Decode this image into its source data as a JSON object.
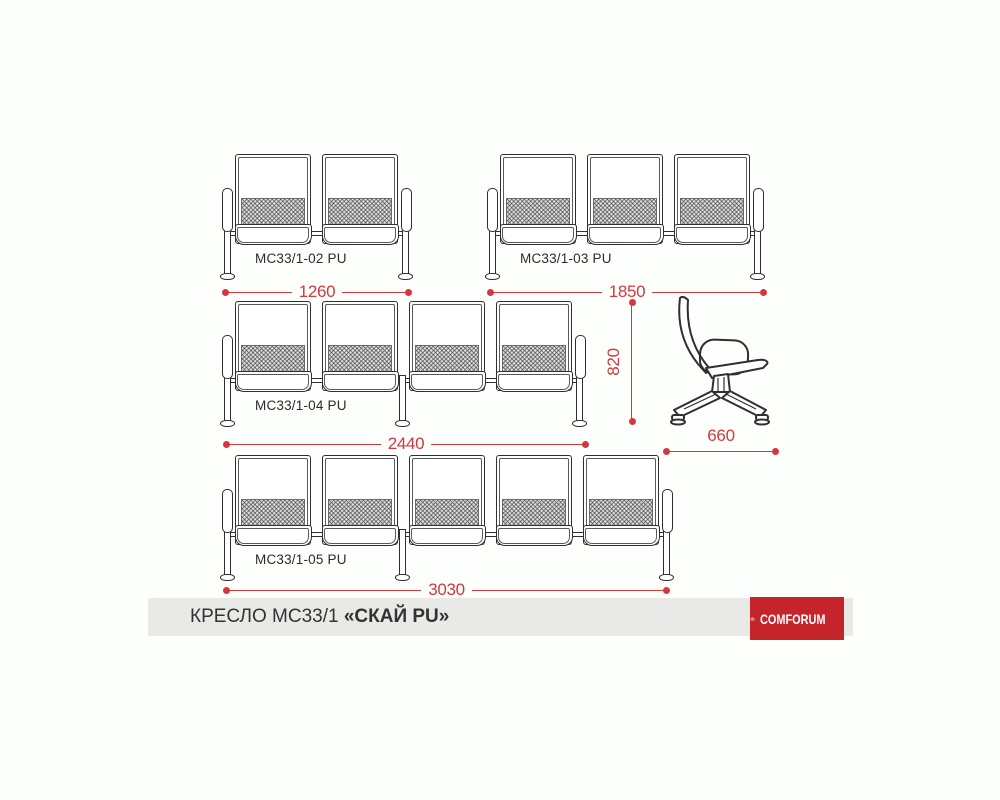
{
  "drawing": {
    "benches": [
      {
        "label": "MC33/1-02 PU",
        "seats": 2,
        "width_mm": "1260"
      },
      {
        "label": "MC33/1-03 PU",
        "seats": 3,
        "width_mm": "1850"
      },
      {
        "label": "MC33/1-04 PU",
        "seats": 4,
        "width_mm": "2440"
      },
      {
        "label": "MC33/1-05 PU",
        "seats": 5,
        "width_mm": "3030"
      }
    ],
    "side_view": {
      "height_mm": "820",
      "depth_mm": "660"
    }
  },
  "footer": {
    "product_title": "КРЕСЛО МС33/1",
    "product_title_accent": "«СКАЙ PU»",
    "brand": "COMFORUM"
  },
  "icons": {
    "brand_icon": "comforum-arch-icon"
  },
  "colors": {
    "dimension_red": "#d2383d",
    "line_dark": "#2f2f2f",
    "logo_red": "#c5242b",
    "footer_bg": "#e9e9e7",
    "page_bg": "#fdfffd"
  }
}
